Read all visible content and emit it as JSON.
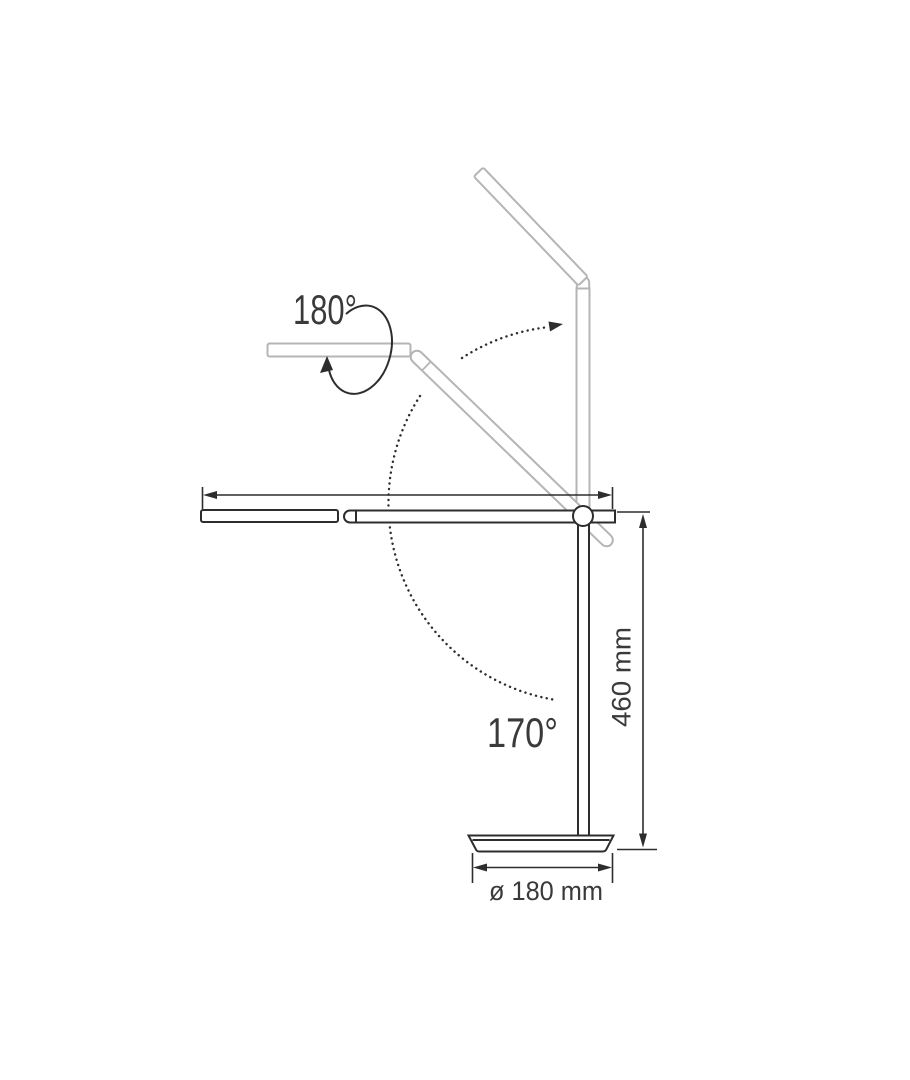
{
  "page": {
    "background": "#ffffff"
  },
  "diagram": {
    "name": "desk-lamp-articulation-and-dimensions-diagram",
    "labels": {
      "head_rotation": "180°",
      "arm_rotation": "170°",
      "height": "460 mm",
      "base_diameter": "ø 180 mm"
    },
    "colors": {
      "solid": "#2d2d2d",
      "ghost": "#b5b5b5",
      "text": "#3a3a3a",
      "background": "#ffffff"
    }
  }
}
